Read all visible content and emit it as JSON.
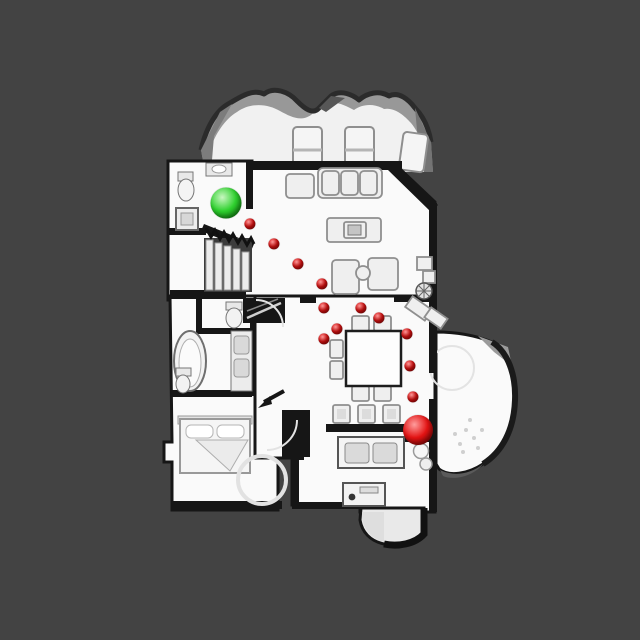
{
  "meta": {
    "view": "top-down-house-scan",
    "canvas_width": 640,
    "canvas_height": 640
  },
  "scene": {
    "background_color": "#434343",
    "floor_color": "#fafafa",
    "wall_color": "#161616",
    "mesh_edge_color": "#989898"
  },
  "markers": {
    "start": {
      "label": "start",
      "x": 226,
      "y": 203,
      "radius": 15.5,
      "color": "#2fd12f",
      "shadow": "#0b7c0b",
      "highlight": "#c9f7c1"
    },
    "goal": {
      "label": "goal",
      "x": 418,
      "y": 430,
      "radius": 15,
      "color": "#e31313",
      "shadow": "#7e0303",
      "highlight": "#ff9d9d"
    },
    "waypoint_style": {
      "radius": 5.6,
      "color": "#e01111",
      "shadow": "#8c0505",
      "highlight": "#ff9c9c"
    },
    "waypoints": [
      {
        "x": 250,
        "y": 224
      },
      {
        "x": 274,
        "y": 244
      },
      {
        "x": 298,
        "y": 264
      },
      {
        "x": 322,
        "y": 284
      },
      {
        "x": 324,
        "y": 308
      },
      {
        "x": 361,
        "y": 308
      },
      {
        "x": 379,
        "y": 318
      },
      {
        "x": 337,
        "y": 329
      },
      {
        "x": 324,
        "y": 339
      },
      {
        "x": 407,
        "y": 334
      },
      {
        "x": 410,
        "y": 366
      },
      {
        "x": 413,
        "y": 397
      }
    ]
  }
}
